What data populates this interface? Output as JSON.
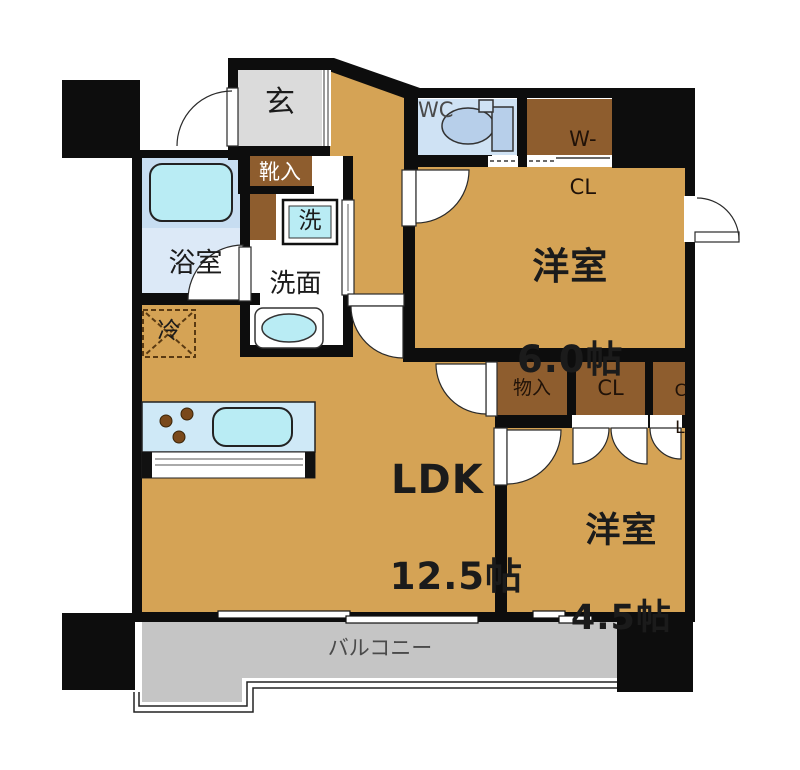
{
  "floorplan": {
    "type": "japanese-apartment-floorplan",
    "labels": {
      "genkan": "玄",
      "shoe": "靴入",
      "bath": "浴室",
      "washer": "洗",
      "vanity": "洗面",
      "fridge": "冷",
      "wc": "WC",
      "wcl_line1": "W-",
      "wcl_line2": "CL",
      "room6_name": "洋室",
      "room6_size": "6.0帖",
      "storage": "物入",
      "cl": "CL",
      "cl2_line1": "C",
      "cl2_line2": "L",
      "room45_name": "洋室",
      "room45_size": "4.5帖",
      "ldk_name": "LDK",
      "ldk_size": "12.5帖",
      "balcony": "バルコニー"
    },
    "colors": {
      "wall": "#0d0d0d",
      "room_tan": "#d5a355",
      "closet_brown": "#8e5d2e",
      "entrance_gray": "#dbdbdb",
      "balcony_gray": "#c5c5c5",
      "bath_blue_upper": "#c7ddf1",
      "bath_blue_lower": "#dce9f7",
      "wc_blue": "#cfe2f4",
      "fixture_cyan": "#b9ecf4",
      "kitchen_blue": "#cfe9f7",
      "toilet_blue": "#b7cfea",
      "fridge_dash": "#5a3a12"
    }
  }
}
